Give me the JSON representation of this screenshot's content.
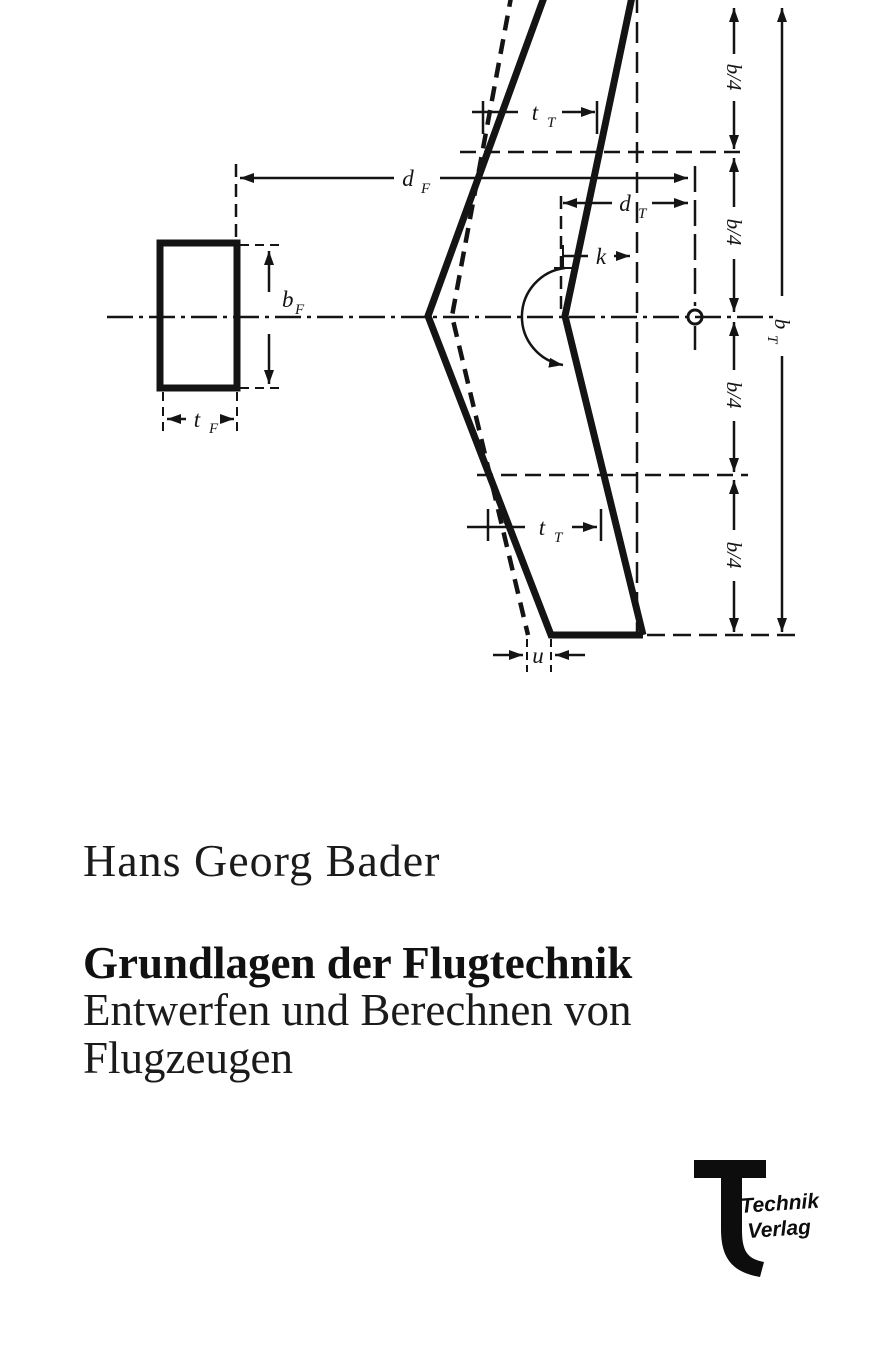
{
  "cover": {
    "author": "Hans Georg Bader",
    "title": "Grundlagen der Flugtechnik",
    "subtitle_line1": "Entwerfen und Berechnen von",
    "subtitle_line2": "Flugzeugen",
    "publisher": {
      "logo_letter": "T",
      "line1": "Technik",
      "line2": "Verlag"
    }
  },
  "diagram": {
    "type": "technical dimension drawing of a swept flying-wing planform with rectangular fin cross-section",
    "ink_color": "#141414",
    "background": "#ffffff",
    "labels": {
      "d_F": {
        "main": "d",
        "sub": "F"
      },
      "d_T": {
        "main": "d",
        "sub": "T"
      },
      "t_T": {
        "main": "t",
        "sub": "T"
      },
      "t_F": {
        "main": "t",
        "sub": "F"
      },
      "b_F": {
        "main": "b",
        "sub": "F"
      },
      "b_T": {
        "main": "b",
        "sub": "T"
      },
      "k": "k",
      "u": "u",
      "quarter_span": "b/4"
    }
  }
}
